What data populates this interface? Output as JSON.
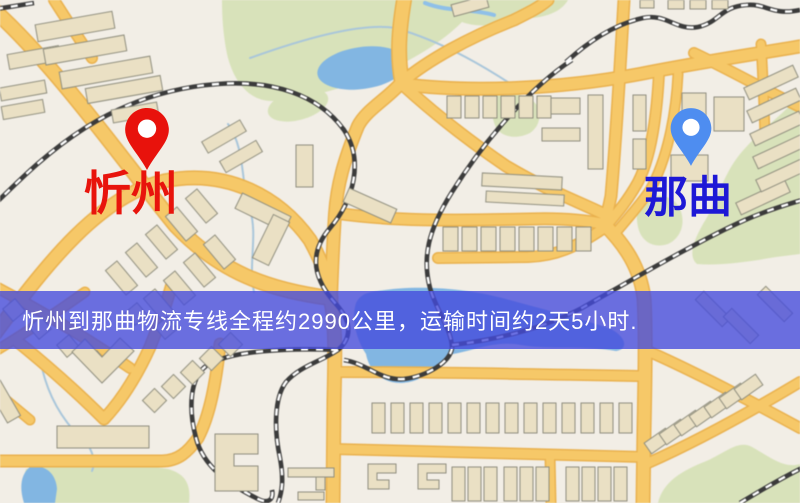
{
  "banner": {
    "text": "忻州到那曲物流专线全程约2990公里，运输时间约2天5小时.",
    "bg_color": "rgba(68,74,220,0.78)",
    "text_color": "#ffffff"
  },
  "markers": {
    "origin": {
      "label": "忻州",
      "pin_color": "#e8120c",
      "label_color": "#e8140c",
      "pin_icon": "red-location-pin"
    },
    "destination": {
      "label": "那曲",
      "pin_color": "#4e8df0",
      "label_color": "#1d18d6",
      "pin_icon": "blue-location-pin"
    }
  },
  "map_colors": {
    "background": "#f2eee6",
    "road": "#f6c868",
    "road_casing": "#e9b14e",
    "building": "#eae0c4",
    "building_outline": "#8f8e7e",
    "park": "#d8e2ba",
    "water": "#82b6e2",
    "railway": "#3b3b3b"
  }
}
